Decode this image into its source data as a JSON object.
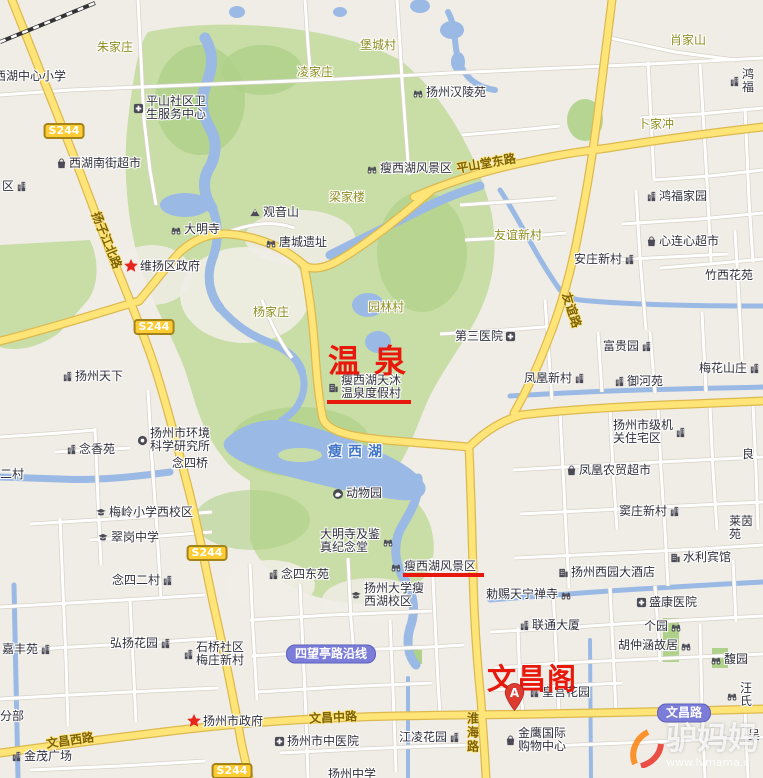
{
  "map": {
    "width": 763,
    "height": 778,
    "colors": {
      "land": "#f0ede6",
      "park": "#c9dda6",
      "park_dark": "#afd189",
      "water": "#9ab9e4",
      "road_white": "#ffffff",
      "road_casing": "#d8d3c8",
      "road_yellow": "#ffe478",
      "road_yellow_casing": "#dcb94f",
      "annotation_red": "#e8180c",
      "badge_yellow": "#ffcc33",
      "badge_purple": "#7b7dd8",
      "rail": "#333333"
    },
    "annotations": [
      {
        "text": "温泉",
        "x": 328,
        "y": 336,
        "size": 32,
        "spacing": 14
      },
      {
        "text": "文昌阁",
        "x": 487,
        "y": 656,
        "size": 29,
        "spacing": 1
      }
    ],
    "underlines": [
      {
        "x": 327,
        "y": 400,
        "w": 84
      },
      {
        "x": 403,
        "y": 573,
        "w": 81
      }
    ],
    "marker": {
      "letter": "A",
      "x": 503,
      "y": 682
    },
    "watermark": {
      "brand": "驴妈妈",
      "url": "www.lvmama.c"
    },
    "lake_label": "瘦西湖",
    "route_badges": [
      {
        "label": "S244",
        "cx": 64,
        "cy": 131
      },
      {
        "label": "S244",
        "cx": 154,
        "cy": 327
      },
      {
        "label": "S244",
        "cx": 207,
        "cy": 553
      },
      {
        "label": "S244",
        "cx": 232,
        "cy": 771
      }
    ],
    "road_name_badges": [
      {
        "label": "四望亭路沿线",
        "cx": 331,
        "cy": 654
      },
      {
        "label": "文昌路",
        "cx": 684,
        "cy": 713
      }
    ],
    "road_labels": [
      {
        "text": "扬子江北路",
        "cx": 107,
        "cy": 240,
        "rotate": 68
      },
      {
        "text": "平山堂东路",
        "cx": 486,
        "cy": 163,
        "rotate": -10
      },
      {
        "text": "友谊路",
        "cx": 572,
        "cy": 310,
        "rotate": 72
      },
      {
        "text": "文昌西路",
        "cx": 70,
        "cy": 740,
        "rotate": -8
      },
      {
        "text": "文昌中路",
        "cx": 333,
        "cy": 717,
        "rotate": -3
      },
      {
        "text": "淮海路",
        "cx": 473,
        "cy": 733,
        "vertical": true
      }
    ],
    "labels": [
      {
        "t": "朱家庄",
        "x": 97,
        "y": 41,
        "kind": "village"
      },
      {
        "t": "堡城村",
        "x": 360,
        "y": 39,
        "kind": "village"
      },
      {
        "t": "凌家庄",
        "x": 297,
        "y": 66,
        "kind": "village"
      },
      {
        "t": "肖家山",
        "x": 670,
        "y": 34,
        "kind": "village"
      },
      {
        "t": "卜家冲",
        "x": 638,
        "y": 118,
        "kind": "village"
      },
      {
        "t": "梁家楼",
        "x": 329,
        "y": 191,
        "kind": "village"
      },
      {
        "t": "杨家庄",
        "x": 253,
        "y": 306,
        "kind": "village"
      },
      {
        "t": "园林村",
        "x": 368,
        "y": 301,
        "kind": "village"
      },
      {
        "t": "友谊新村",
        "x": 494,
        "y": 229,
        "kind": "village"
      },
      {
        "t": "西湖中心小学",
        "x": -6,
        "y": 70,
        "kind": "poi"
      },
      {
        "t": "平山社区卫\n生服务中心",
        "x": 133,
        "y": 95,
        "icon": "hospital",
        "side": "l",
        "kind": "poi"
      },
      {
        "t": "西湖南街超市",
        "x": 56,
        "y": 157,
        "icon": "shop",
        "side": "l",
        "kind": "poi"
      },
      {
        "t": "区",
        "x": 2,
        "y": 180,
        "icon": "building",
        "side": "r",
        "kind": "poi"
      },
      {
        "t": "扬州汉陵苑",
        "x": 412,
        "y": 86,
        "icon": "scenic",
        "side": "l",
        "kind": "poi"
      },
      {
        "t": "瘦西湖风景区",
        "x": 366,
        "y": 162,
        "icon": "scenic",
        "side": "l",
        "kind": "poi"
      },
      {
        "t": "观音山",
        "x": 249,
        "y": 206,
        "icon": "mountain",
        "side": "l",
        "kind": "poi"
      },
      {
        "t": "唐城遗址",
        "x": 265,
        "y": 236,
        "icon": "scenic",
        "side": "l",
        "kind": "poi"
      },
      {
        "t": "大明寺",
        "x": 170,
        "y": 223,
        "icon": "scenic",
        "side": "l",
        "kind": "poi"
      },
      {
        "t": "维扬区政府",
        "x": 124,
        "y": 259,
        "icon": "star",
        "side": "l",
        "kind": "poi"
      },
      {
        "t": "扬州天下",
        "x": 62,
        "y": 370,
        "icon": "building",
        "side": "l",
        "kind": "poi"
      },
      {
        "t": "瘦西湖天沐\n温泉度假村",
        "x": 328,
        "y": 374,
        "icon": "hotel",
        "side": "l",
        "kind": "poi"
      },
      {
        "t": "扬州市环境\n科学研究所",
        "x": 137,
        "y": 427,
        "icon": "institute",
        "side": "l",
        "kind": "poi"
      },
      {
        "t": "念香苑",
        "x": 66,
        "y": 443,
        "icon": "building",
        "side": "l",
        "kind": "poi"
      },
      {
        "t": "念四桥",
        "x": 172,
        "y": 457,
        "kind": "poi"
      },
      {
        "t": "二村",
        "x": 0,
        "y": 468,
        "kind": "poi"
      },
      {
        "t": "梅岭小学西校区",
        "x": 95,
        "y": 506,
        "icon": "school",
        "side": "l",
        "kind": "poi"
      },
      {
        "t": "翠岗中学",
        "x": 97,
        "y": 531,
        "icon": "school",
        "side": "l",
        "kind": "poi"
      },
      {
        "t": "念四二村",
        "x": 112,
        "y": 574,
        "icon": "building",
        "side": "r",
        "kind": "poi"
      },
      {
        "t": "动物园",
        "x": 332,
        "y": 487,
        "icon": "zoo",
        "side": "l",
        "kind": "poi"
      },
      {
        "t": "大明寺及鉴\n真纪念堂",
        "x": 320,
        "y": 528,
        "icon": "scenic",
        "side": "r",
        "kind": "poi"
      },
      {
        "t": "瘦西湖风景区",
        "x": 390,
        "y": 560,
        "icon": "scenic",
        "side": "l",
        "kind": "poi"
      },
      {
        "t": "念四东苑",
        "x": 268,
        "y": 568,
        "icon": "building",
        "side": "l",
        "kind": "poi"
      },
      {
        "t": "扬州大学瘦\n西湖校区",
        "x": 350,
        "y": 582,
        "icon": "school",
        "side": "l",
        "kind": "poi"
      },
      {
        "t": "嘉丰苑",
        "x": 2,
        "y": 643,
        "icon": "building",
        "side": "r",
        "kind": "poi"
      },
      {
        "t": "弘扬花园",
        "x": 110,
        "y": 637,
        "icon": "building",
        "side": "r",
        "kind": "poi"
      },
      {
        "t": "石桥社区\n梅庄新村",
        "x": 183,
        "y": 641,
        "icon": "building",
        "side": "l",
        "kind": "poi"
      },
      {
        "t": "分部",
        "x": 0,
        "y": 710,
        "kind": "poi"
      },
      {
        "t": "扬州市政府",
        "x": 187,
        "y": 714,
        "icon": "star",
        "side": "l",
        "kind": "poi"
      },
      {
        "t": "金茂广场",
        "x": 11,
        "y": 750,
        "icon": "building",
        "side": "l",
        "kind": "poi"
      },
      {
        "t": "扬州市中医院",
        "x": 274,
        "y": 735,
        "icon": "hospital",
        "side": "l",
        "kind": "poi"
      },
      {
        "t": "江凌花园",
        "x": 399,
        "y": 731,
        "icon": "building",
        "side": "r",
        "kind": "poi"
      },
      {
        "t": "扬州中学",
        "x": 328,
        "y": 768,
        "kind": "poi"
      },
      {
        "t": "金鹰国际\n购物中心",
        "x": 505,
        "y": 727,
        "icon": "shop",
        "side": "l",
        "kind": "poi"
      },
      {
        "t": "皇宫花园",
        "x": 529,
        "y": 686,
        "icon": "building",
        "side": "l",
        "kind": "poi"
      },
      {
        "t": "联通大厦",
        "x": 519,
        "y": 619,
        "icon": "building",
        "side": "l",
        "kind": "poi"
      },
      {
        "t": "勅赐天宁禅寺",
        "x": 486,
        "y": 588,
        "icon": "scenic",
        "side": "r",
        "kind": "poi"
      },
      {
        "t": "盛康医院",
        "x": 636,
        "y": 596,
        "icon": "hospital",
        "side": "l",
        "kind": "poi"
      },
      {
        "t": "扬州西园大酒店",
        "x": 558,
        "y": 566,
        "icon": "hotel",
        "side": "l",
        "kind": "poi"
      },
      {
        "t": "水利宾馆",
        "x": 670,
        "y": 551,
        "icon": "hotel",
        "side": "l",
        "kind": "poi"
      },
      {
        "t": "个园",
        "x": 644,
        "y": 620,
        "icon": "scenic",
        "side": "r",
        "kind": "poi"
      },
      {
        "t": "胡仲涵故居",
        "x": 618,
        "y": 639,
        "icon": "scenic",
        "side": "r",
        "kind": "poi"
      },
      {
        "t": "馥园",
        "x": 710,
        "y": 653,
        "icon": "scenic",
        "side": "l",
        "kind": "poi"
      },
      {
        "t": "汪氏",
        "x": 726,
        "y": 682,
        "icon": "scenic",
        "side": "l",
        "kind": "poi"
      },
      {
        "t": "吴",
        "x": 748,
        "y": 729,
        "kind": "poi"
      },
      {
        "t": "窦庄新村",
        "x": 619,
        "y": 505,
        "icon": "building",
        "side": "r",
        "kind": "poi"
      },
      {
        "t": "莱茵苑",
        "x": 729,
        "y": 515,
        "kind": "poi"
      },
      {
        "t": "良",
        "x": 742,
        "y": 448,
        "kind": "poi"
      },
      {
        "t": "凤凰农贸超市",
        "x": 566,
        "y": 464,
        "icon": "shop",
        "side": "l",
        "kind": "poi"
      },
      {
        "t": "扬州市级机\n关住宅区",
        "x": 613,
        "y": 419,
        "icon": "building",
        "side": "r",
        "kind": "poi"
      },
      {
        "t": "凤凰新村",
        "x": 524,
        "y": 372,
        "icon": "building",
        "side": "r",
        "kind": "poi"
      },
      {
        "t": "御河苑",
        "x": 614,
        "y": 375,
        "icon": "building",
        "side": "l",
        "kind": "poi"
      },
      {
        "t": "梅花山庄",
        "x": 699,
        "y": 362,
        "icon": "building",
        "side": "r",
        "kind": "poi"
      },
      {
        "t": "富贵园",
        "x": 603,
        "y": 340,
        "icon": "building",
        "side": "r",
        "kind": "poi"
      },
      {
        "t": "第三医院",
        "x": 455,
        "y": 330,
        "icon": "hospital",
        "side": "r",
        "kind": "poi"
      },
      {
        "t": "安庄新村",
        "x": 574,
        "y": 253,
        "icon": "building",
        "side": "r",
        "kind": "poi"
      },
      {
        "t": "心连心超市",
        "x": 646,
        "y": 235,
        "icon": "shop",
        "side": "l",
        "kind": "poi"
      },
      {
        "t": "鸿福家园",
        "x": 646,
        "y": 190,
        "icon": "building",
        "side": "l",
        "kind": "poi"
      },
      {
        "t": "鸿福",
        "x": 729,
        "y": 68,
        "icon": "building",
        "side": "l",
        "kind": "poi"
      },
      {
        "t": "竹西花苑",
        "x": 705,
        "y": 269,
        "kind": "poi"
      }
    ]
  }
}
